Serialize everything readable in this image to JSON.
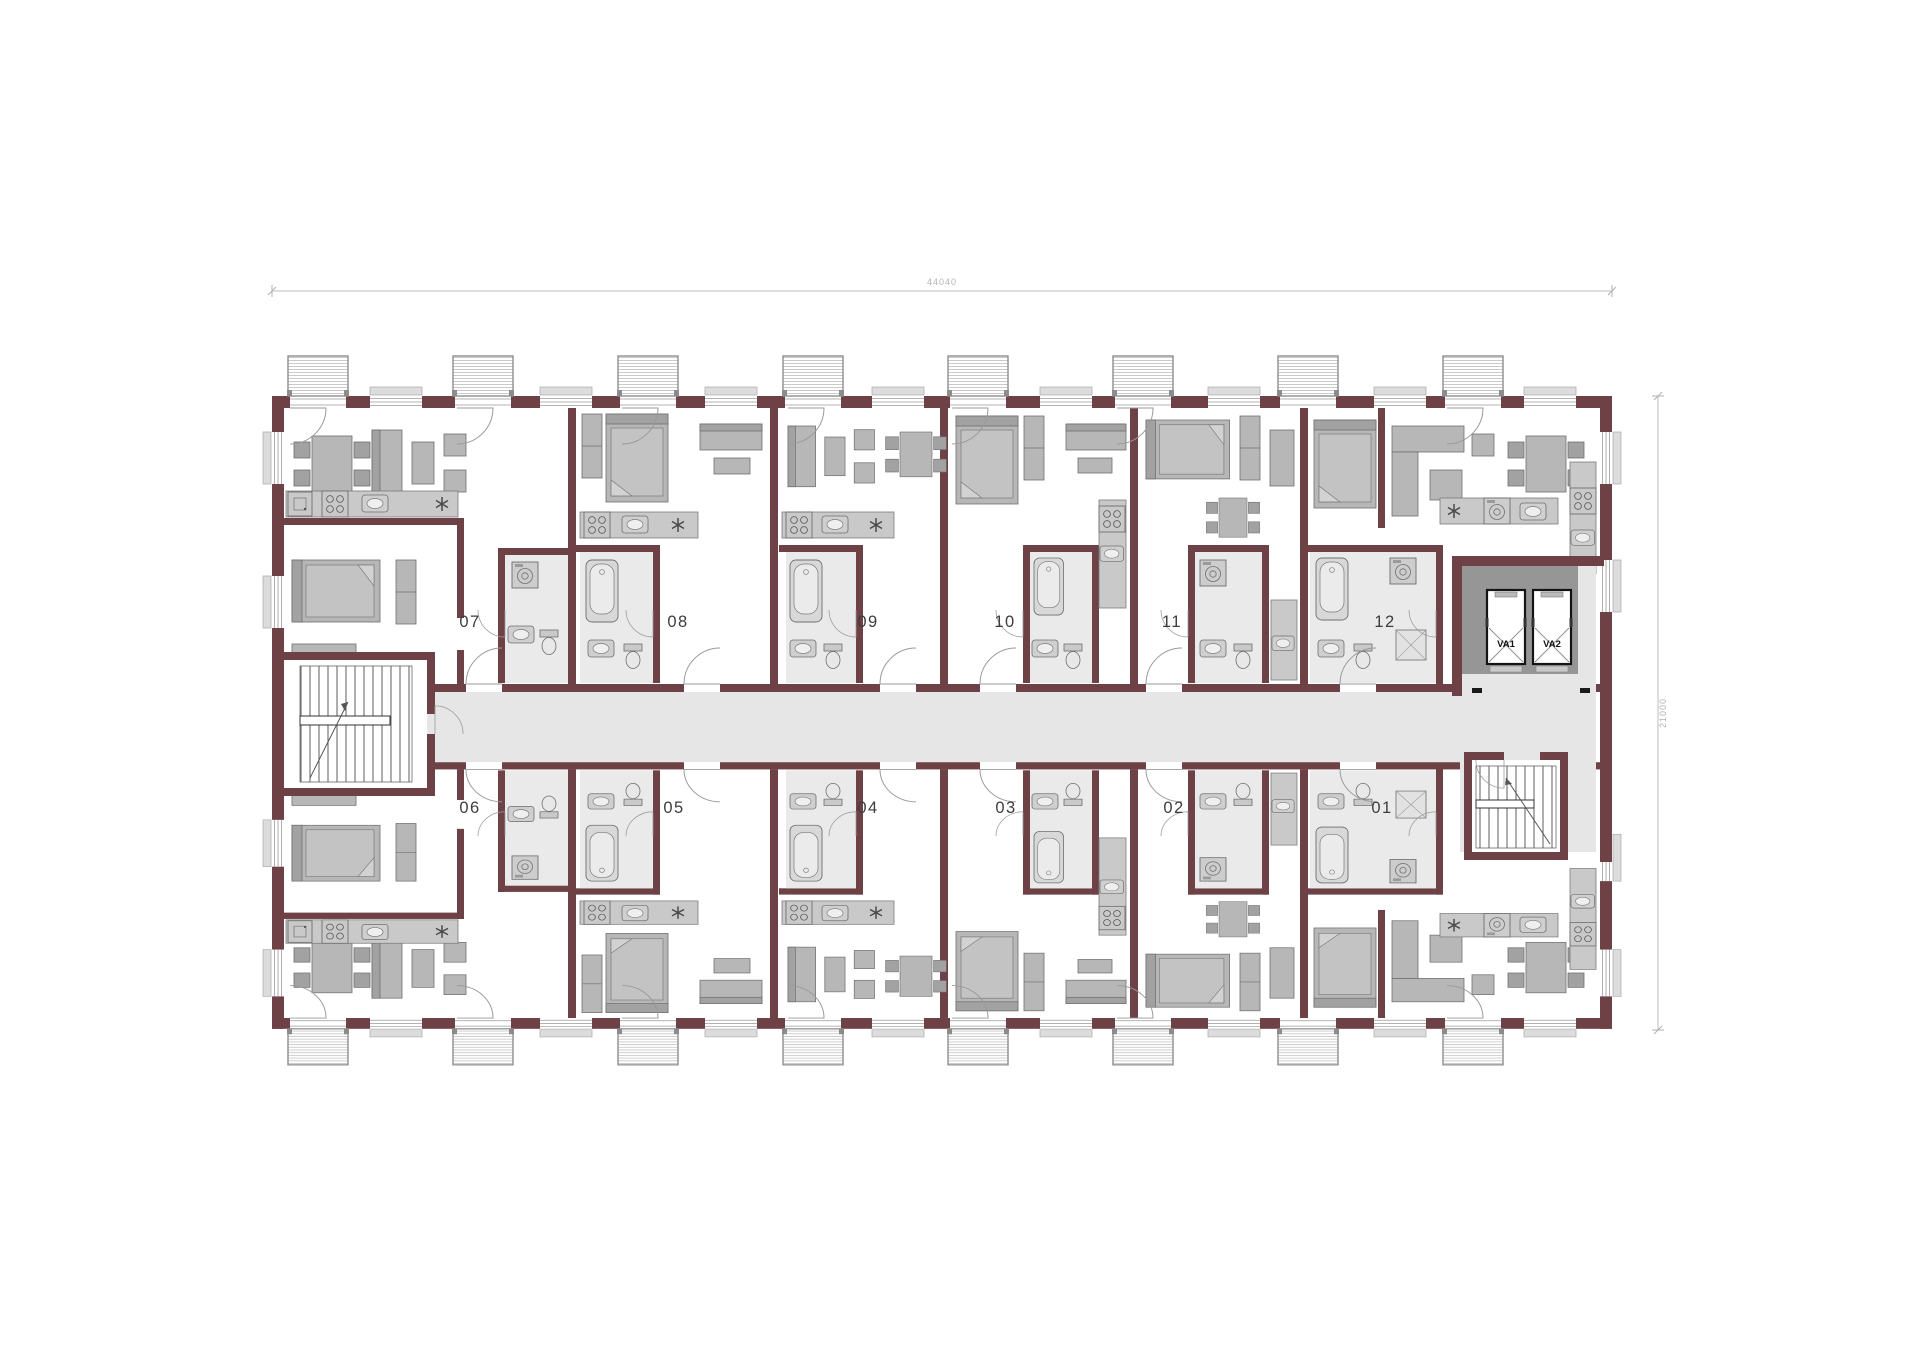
{
  "page": {
    "type": "architectural floor plan",
    "background": "#ffffff"
  },
  "dimensions": {
    "top": "44040",
    "right": "21000"
  },
  "units": [
    {
      "id": "07",
      "label": "07"
    },
    {
      "id": "08",
      "label": "08"
    },
    {
      "id": "09",
      "label": "09"
    },
    {
      "id": "10",
      "label": "10"
    },
    {
      "id": "11",
      "label": "11"
    },
    {
      "id": "12",
      "label": "12"
    },
    {
      "id": "06",
      "label": "06"
    },
    {
      "id": "05",
      "label": "05"
    },
    {
      "id": "04",
      "label": "04"
    },
    {
      "id": "03",
      "label": "03"
    },
    {
      "id": "02",
      "label": "02"
    },
    {
      "id": "01",
      "label": "01"
    }
  ],
  "elevators": [
    {
      "id": "va1",
      "label": "VA1"
    },
    {
      "id": "va2",
      "label": "VA2"
    }
  ],
  "colors": {
    "wall": "#6e4146",
    "furniture": "#b7b7b7",
    "corridor_floor": "#e6e6e6",
    "bathroom_floor": "#eaeaea",
    "dimension_text": "#b3b3b3",
    "label_text": "#3d3d3d"
  }
}
